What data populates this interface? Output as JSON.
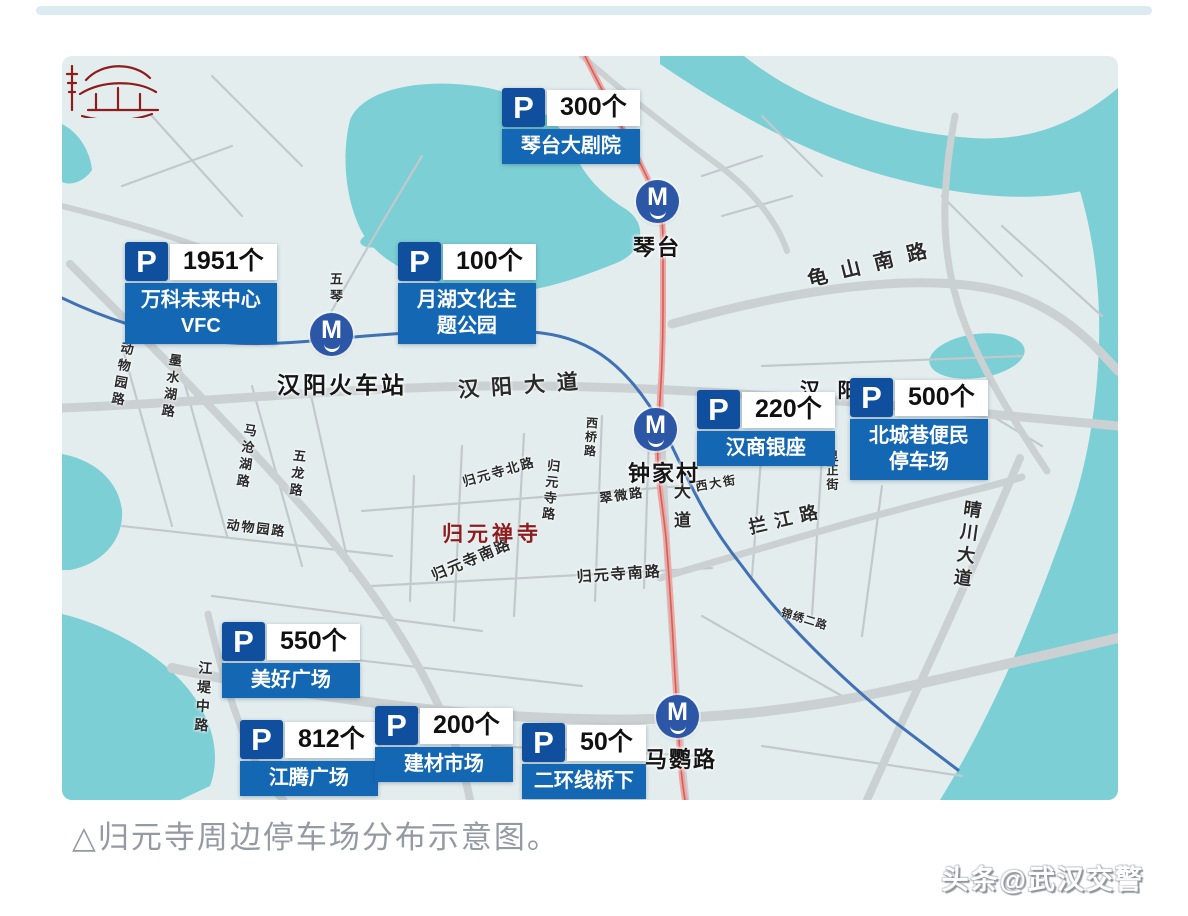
{
  "caption": "△归元寺周边停车场分布示意图。",
  "watermark": "头条@武汉交警",
  "map": {
    "parking_icon": "P",
    "metro_icon_letter": "M",
    "parking": [
      {
        "count": "300个",
        "line1": "琴台大剧院",
        "line2": ""
      },
      {
        "count": "1951个",
        "line1": "万科未来中心",
        "line2": "VFC"
      },
      {
        "count": "100个",
        "line1": "月湖文化主",
        "line2": "题公园"
      },
      {
        "count": "220个",
        "line1": "汉商银座",
        "line2": ""
      },
      {
        "count": "500个",
        "line1": "北城巷便民",
        "line2": "停车场"
      },
      {
        "count": "550个",
        "line1": "美好广场",
        "line2": ""
      },
      {
        "count": "812个",
        "line1": "江腾广场",
        "line2": ""
      },
      {
        "count": "200个",
        "line1": "建材市场",
        "line2": ""
      },
      {
        "count": "50个",
        "line1": "二环线桥下",
        "line2": ""
      }
    ],
    "metro_stations": {
      "qintai": "琴台",
      "zhongjiacun": "钟家村",
      "mayinglu": "马鹦路"
    },
    "places": {
      "hanyang_railway_station": "汉阳火车站",
      "hanyang": "汉 阳"
    },
    "temple_name": "归元禅寺",
    "roads": {
      "hanyang_dadao": "汉阳大道",
      "guishan_nanlu": "龟山南路",
      "lanjiang_lu": "拦江路",
      "qingchuan_dadao": "晴川大道",
      "guiyuansi_nanlu_w": "归元寺南路",
      "guiyuansi_nanlu_e": "归元寺南路",
      "cuiwei_lu": "翠微路",
      "guiyuansi_lu": "归元寺路",
      "guiyuansi_beilu": "归元寺北路",
      "xi_dajie": "西大街",
      "xianzheng_jie": "显正街",
      "xiqiao_lu": "西桥路",
      "dadao": "大道",
      "jiangdi_zhonglu": "江堤中路",
      "dongwuyuan_lu_n": "动物园路",
      "dongwuyuan_lu_s": "动物园路",
      "moshuihu_lu": "墨水湖路",
      "macanghu_lu": "马沧湖路",
      "wulong_lu": "五龙路",
      "wuqin_lu": "五琴",
      "jinxiu_erlu": "锦绣二路"
    }
  },
  "colors": {
    "water": "#7ccfd5",
    "map_bg": "#e3edee",
    "road": "#cbd1d3",
    "road_minor": "#c2c9cc",
    "metro_line": "#eca7a3",
    "metro_line_core": "#d4605c",
    "river_line": "#4071b4",
    "parking_badge": "#0f4f9e",
    "parking_banner": "#1467b3",
    "metro_icon_bg": "#2c57a7",
    "temple_red": "#8e1c1c",
    "label_ink": "#2a2a2a",
    "caption_gray": "#949aa3"
  }
}
